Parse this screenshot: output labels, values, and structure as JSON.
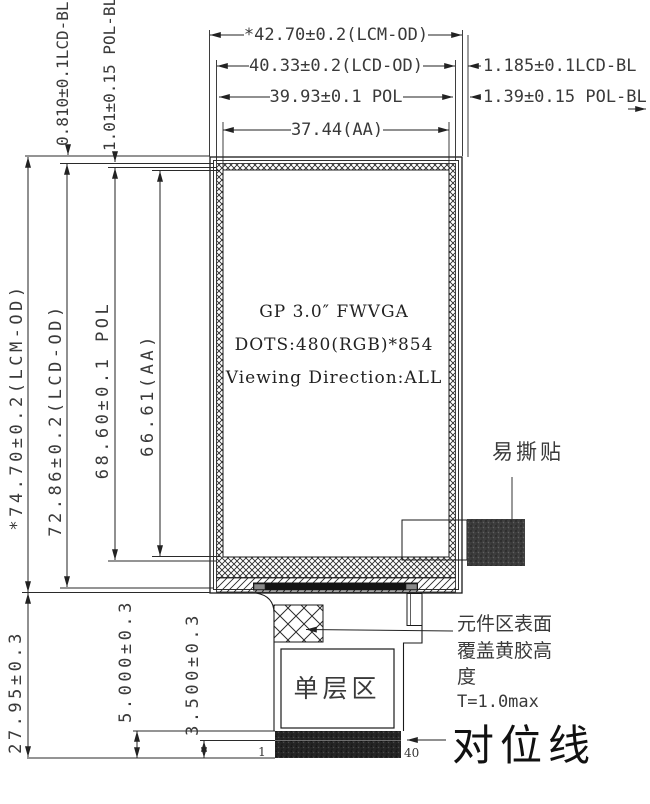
{
  "dims": {
    "top": {
      "lcm": "*42.70±0.2(LCM-OD)",
      "lcd": "40.33±0.2(LCD-OD)",
      "pol": "39.93±0.1 POL",
      "aa": "37.44(AA)"
    },
    "right": {
      "lcd_bl": "1.185±0.1LCD-BL",
      "pol_bl": "1.39±0.15 POL-BL"
    },
    "left": {
      "lcd_bl": "0.810±0.1LCD-BL",
      "pol_bl": "1.01±0.15 POL-BL",
      "lcm": "*74.70±0.2(LCM-OD)",
      "lcd": "72.86±0.2(LCD-OD)",
      "pol": "68.60±0.1 POL",
      "aa": "66.61(AA)"
    },
    "bottom": {
      "fpc": "27.95±0.3",
      "d5": "5.000±0.3",
      "d35": "3.500±0.3"
    }
  },
  "display": {
    "line1": "GP 3.0″ FWVGA",
    "line2": "DOTS:480(RGB)*854",
    "line3": "Viewing Direction:ALL"
  },
  "labels": {
    "easy_tear": "易撕贴",
    "note1": "元件区表面",
    "note2": "覆盖黄胶高",
    "note3": "度",
    "note4": "T=1.0max",
    "single_layer": "单层区",
    "align": "对位线",
    "pin1": "1",
    "pin40": "40"
  },
  "colors": {
    "line": "#222222",
    "text": "#3a3a3a",
    "sticker": "#3d3d3d",
    "stiffener_bar": "#262626"
  }
}
